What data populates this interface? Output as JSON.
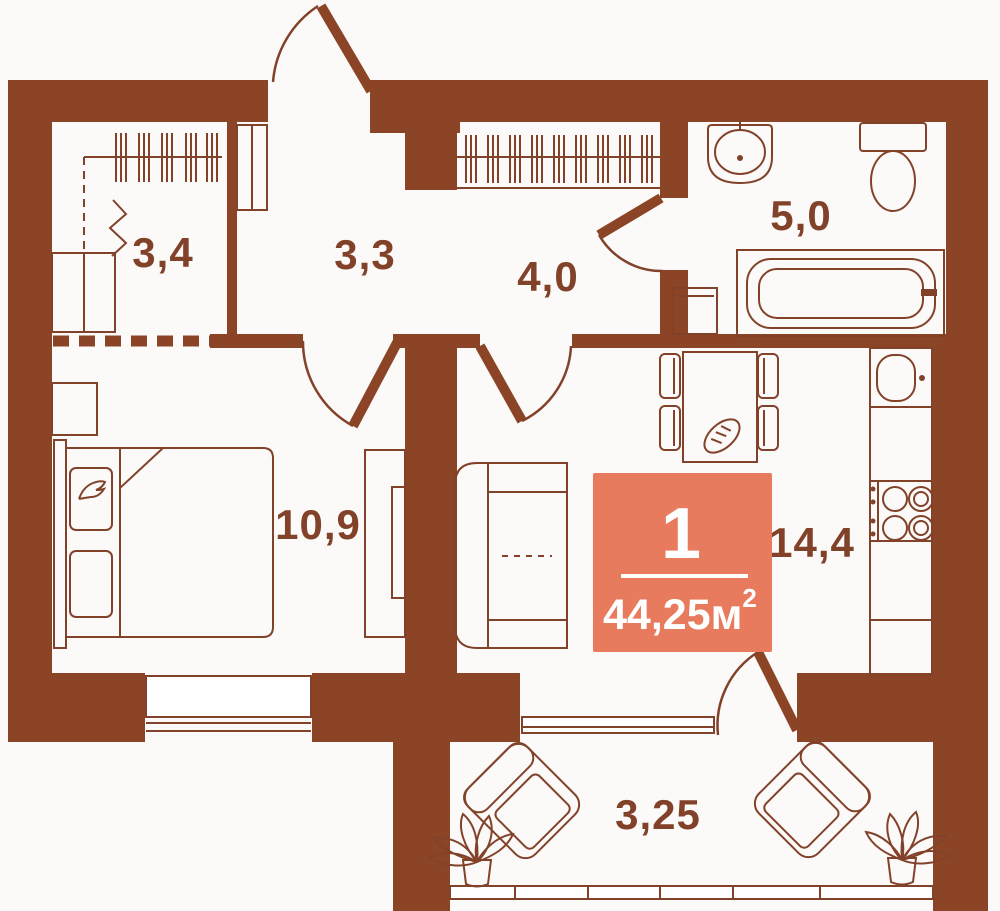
{
  "plan": {
    "title_badge": {
      "number": "1",
      "area_label": "44,25м",
      "area_sup": "2"
    },
    "rooms": [
      {
        "id": "dressing-room",
        "label": "3,4"
      },
      {
        "id": "hallway",
        "label": "3,3"
      },
      {
        "id": "corridor",
        "label": "4,0"
      },
      {
        "id": "bathroom",
        "label": "5,0"
      },
      {
        "id": "bedroom",
        "label": "10,9"
      },
      {
        "id": "kitchen-living",
        "label": "14,4"
      },
      {
        "id": "balcony",
        "label": "3,25"
      }
    ],
    "colors": {
      "wall": "#8B4526",
      "line": "#82422A",
      "badge": "#E87B5D",
      "badge_text": "#FFFFFF",
      "bg": "#FBFAF8",
      "floor": "#FFFFFF"
    }
  }
}
